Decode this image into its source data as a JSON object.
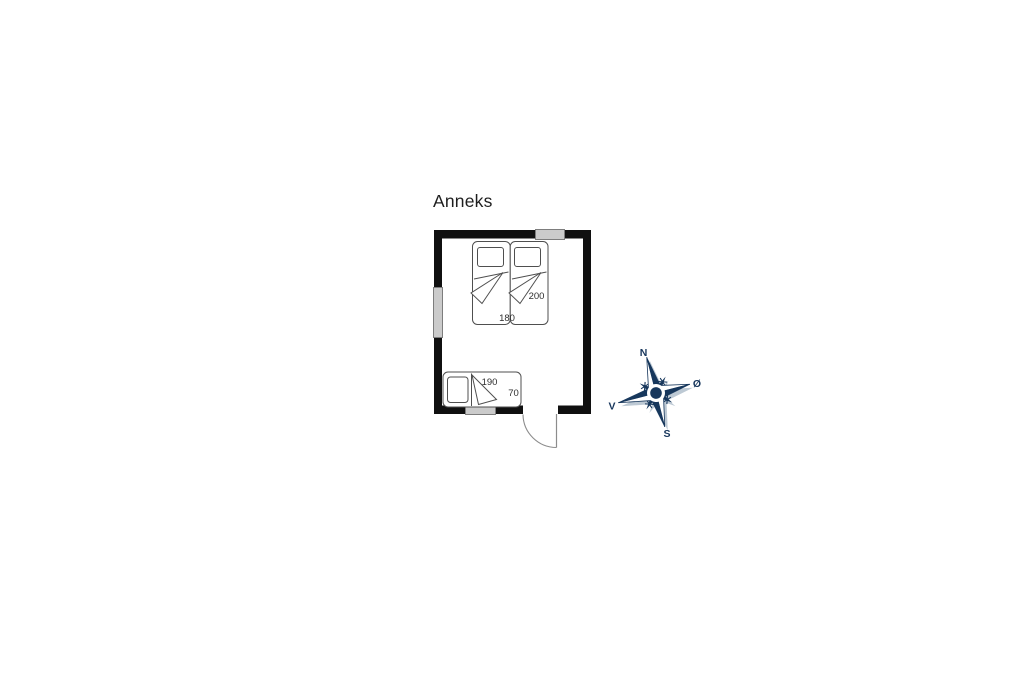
{
  "title": "Anneks",
  "room": {
    "name_label": "Anneks",
    "double_bed": {
      "length_cm": "200",
      "width_cm": "180"
    },
    "single_bed": {
      "length_cm": "190",
      "width_cm": "70"
    }
  },
  "compass": {
    "north": "N",
    "east": "Ø",
    "south": "S",
    "west": "V"
  },
  "colors": {
    "wall": "#101010",
    "furniture_line": "#4f4f4f",
    "window_fill": "#cbcbcb",
    "window_border": "#7d7d7d",
    "door_line": "#8c8c8c",
    "compass_primary": "#17375c",
    "compass_shadow": "#bdc9d4",
    "background": "#ffffff"
  }
}
